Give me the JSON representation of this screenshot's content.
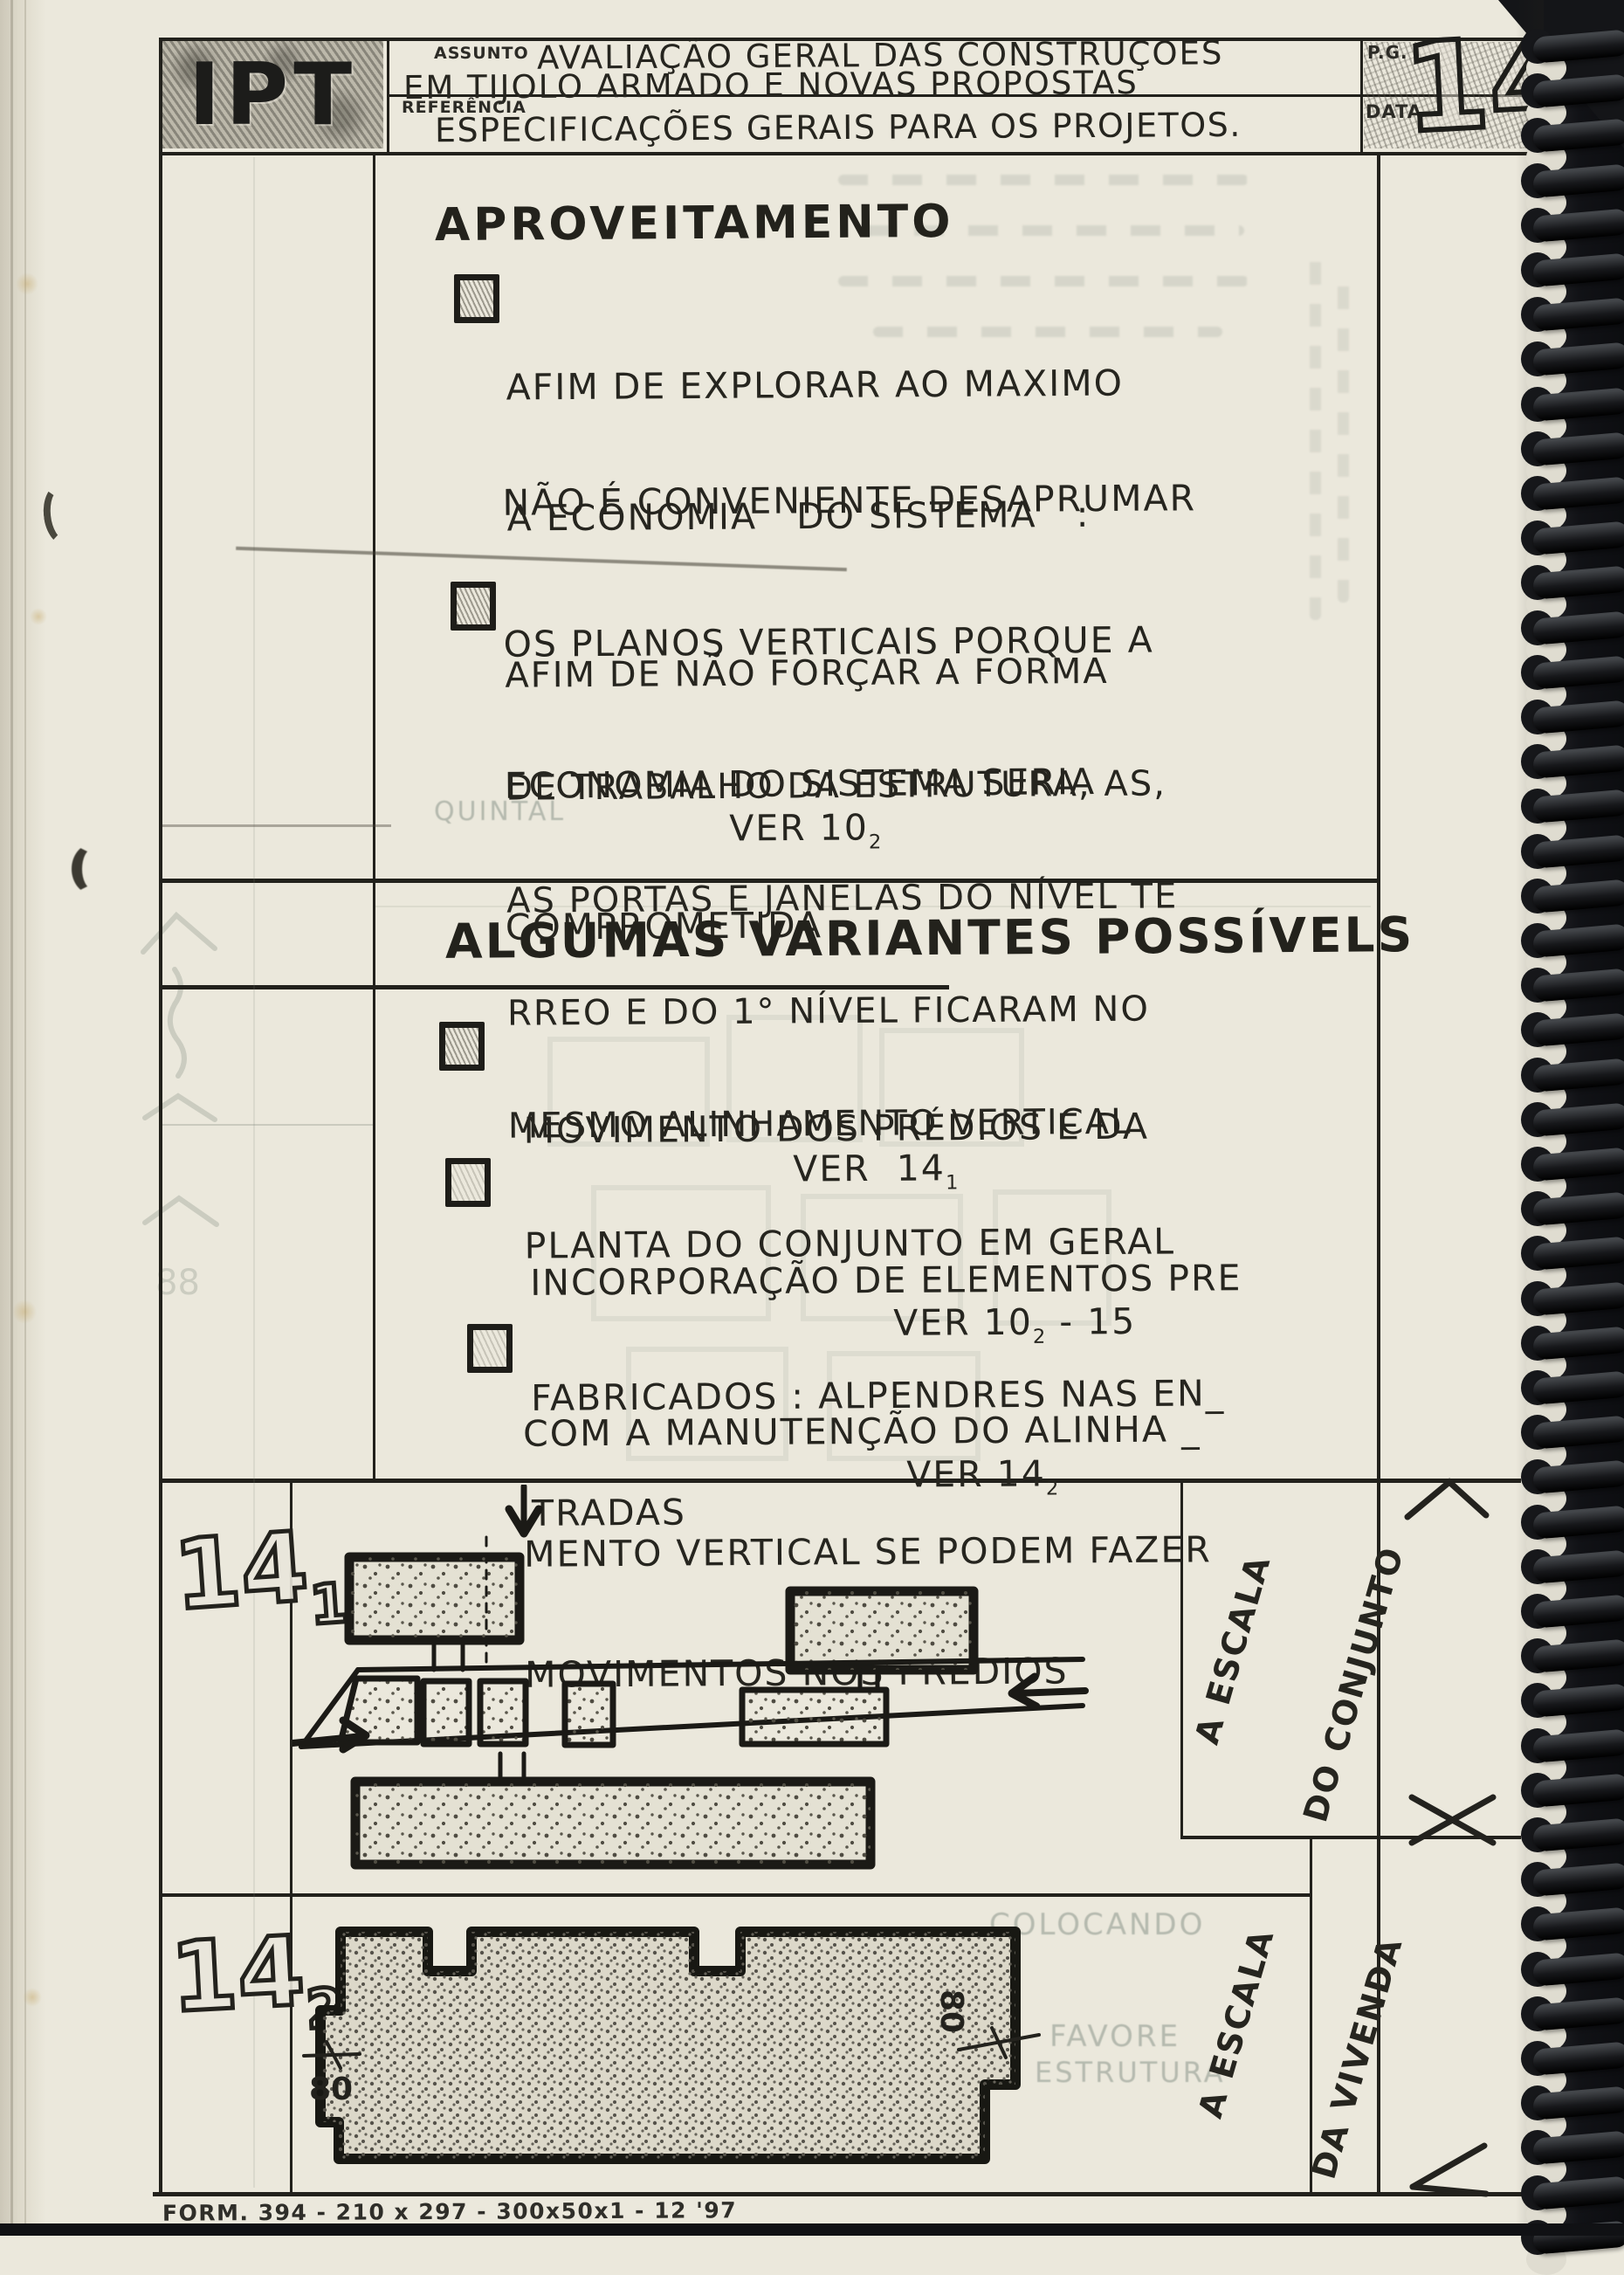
{
  "colors": {
    "paper": "#ebe8dc",
    "ink": "#26251f",
    "frame": "#22211c",
    "pencil": "#6e6a60",
    "binding": "#141518"
  },
  "header": {
    "logo": "IPT",
    "assunto_label": "ASSUNTO",
    "assunto_line1": "AVALIAÇÃO GERAL DAS CONSTRUÇOES",
    "assunto_line2": "EM TIJOLO ARMADO E NOVAS PROPOSTAS",
    "referencia_label": "REFERÊNCIA",
    "referencia_text": "ESPECIFICAÇÕES GERAIS PARA OS PROJETOS.",
    "pg_label": "P.G.",
    "data_label": "DATA",
    "page_number": "14"
  },
  "s1": {
    "title": "APROVEITAMENTO",
    "b1_l1": "AFIM DE EXPLORAR AO MAXIMO",
    "b1_l2": "A ECONOMIA   DO SISTEMA   :",
    "note_l1": "NÃO É CONVENIENTE DESAPRUMAR",
    "note_l2": "OS PLANOS VERTICAIS PORQUE A",
    "note_l3": "ECONOMIA DO SISTEMA SERIA",
    "note_l4": "COMPROMETIDA",
    "b2_l1": "AFIM DE NÃO FORÇAR A FORMA",
    "b2_l2": "DE TRABALHO DA ESTRUTURA, AS,",
    "b2_l3": "AS PORTAS E JANELAS DO NÍVEL TE",
    "b2_l4": "RREO E DO 1° NÍVEL FICARAM NO",
    "b2_l5": "MESMO ALINHAMENTO VERTICAL",
    "b2_ref": "VER 10",
    "b2_ref_sub": "2"
  },
  "s2": {
    "title": "ALGUMAS VARIANTES POSSÍVELS",
    "b1_l1": "MOVIMENTO DOS PRÉDIOS E DA",
    "b1_l2": "PLANTA DO CONJUNTO EM GERAL",
    "b1_ref": "VER  14",
    "b1_ref_sub": "1",
    "b2_l1": "INCORPORAÇÃO DE ELEMENTOS PRE",
    "b2_l2": "FABRICADOS : ALPENDRES NAS EN_",
    "b2_l3": "TRADAS",
    "b2_ref": "VER 10",
    "b2_ref_sub": "2",
    "b2_ref_tail": " - 15",
    "b3_l1": "COM A MANUTENÇÃO DO ALINHA _",
    "b3_l2": "MENTO VERTICAL SE PODEM FAZER",
    "b3_l3": "MOVIMENTOS NOS PREDIOS",
    "b3_ref": "VER 14",
    "b3_ref_sub": "2"
  },
  "figures": {
    "f1_num": "14",
    "f1_sub": "1",
    "f2_num": "14",
    "f2_sub": "2",
    "f2_dim_left": "80",
    "f2_dim_right": "80"
  },
  "margin": {
    "conjunto_l1": "A ESCALA",
    "conjunto_l2": "DO CONJUNTO",
    "vivenda_l1": "A ESCALA",
    "vivenda_l2": "DA VIVENDA"
  },
  "ghosts": {
    "w_quintal": "QUINTAL",
    "w_colocando": "COLOCANDO",
    "w_favore": "FAVORE",
    "w_estrutura": "ESTRUTURA"
  },
  "footer": {
    "form_text": "FORM. 394 - 210 x 297 - 300x50x1 - 12 '97"
  }
}
